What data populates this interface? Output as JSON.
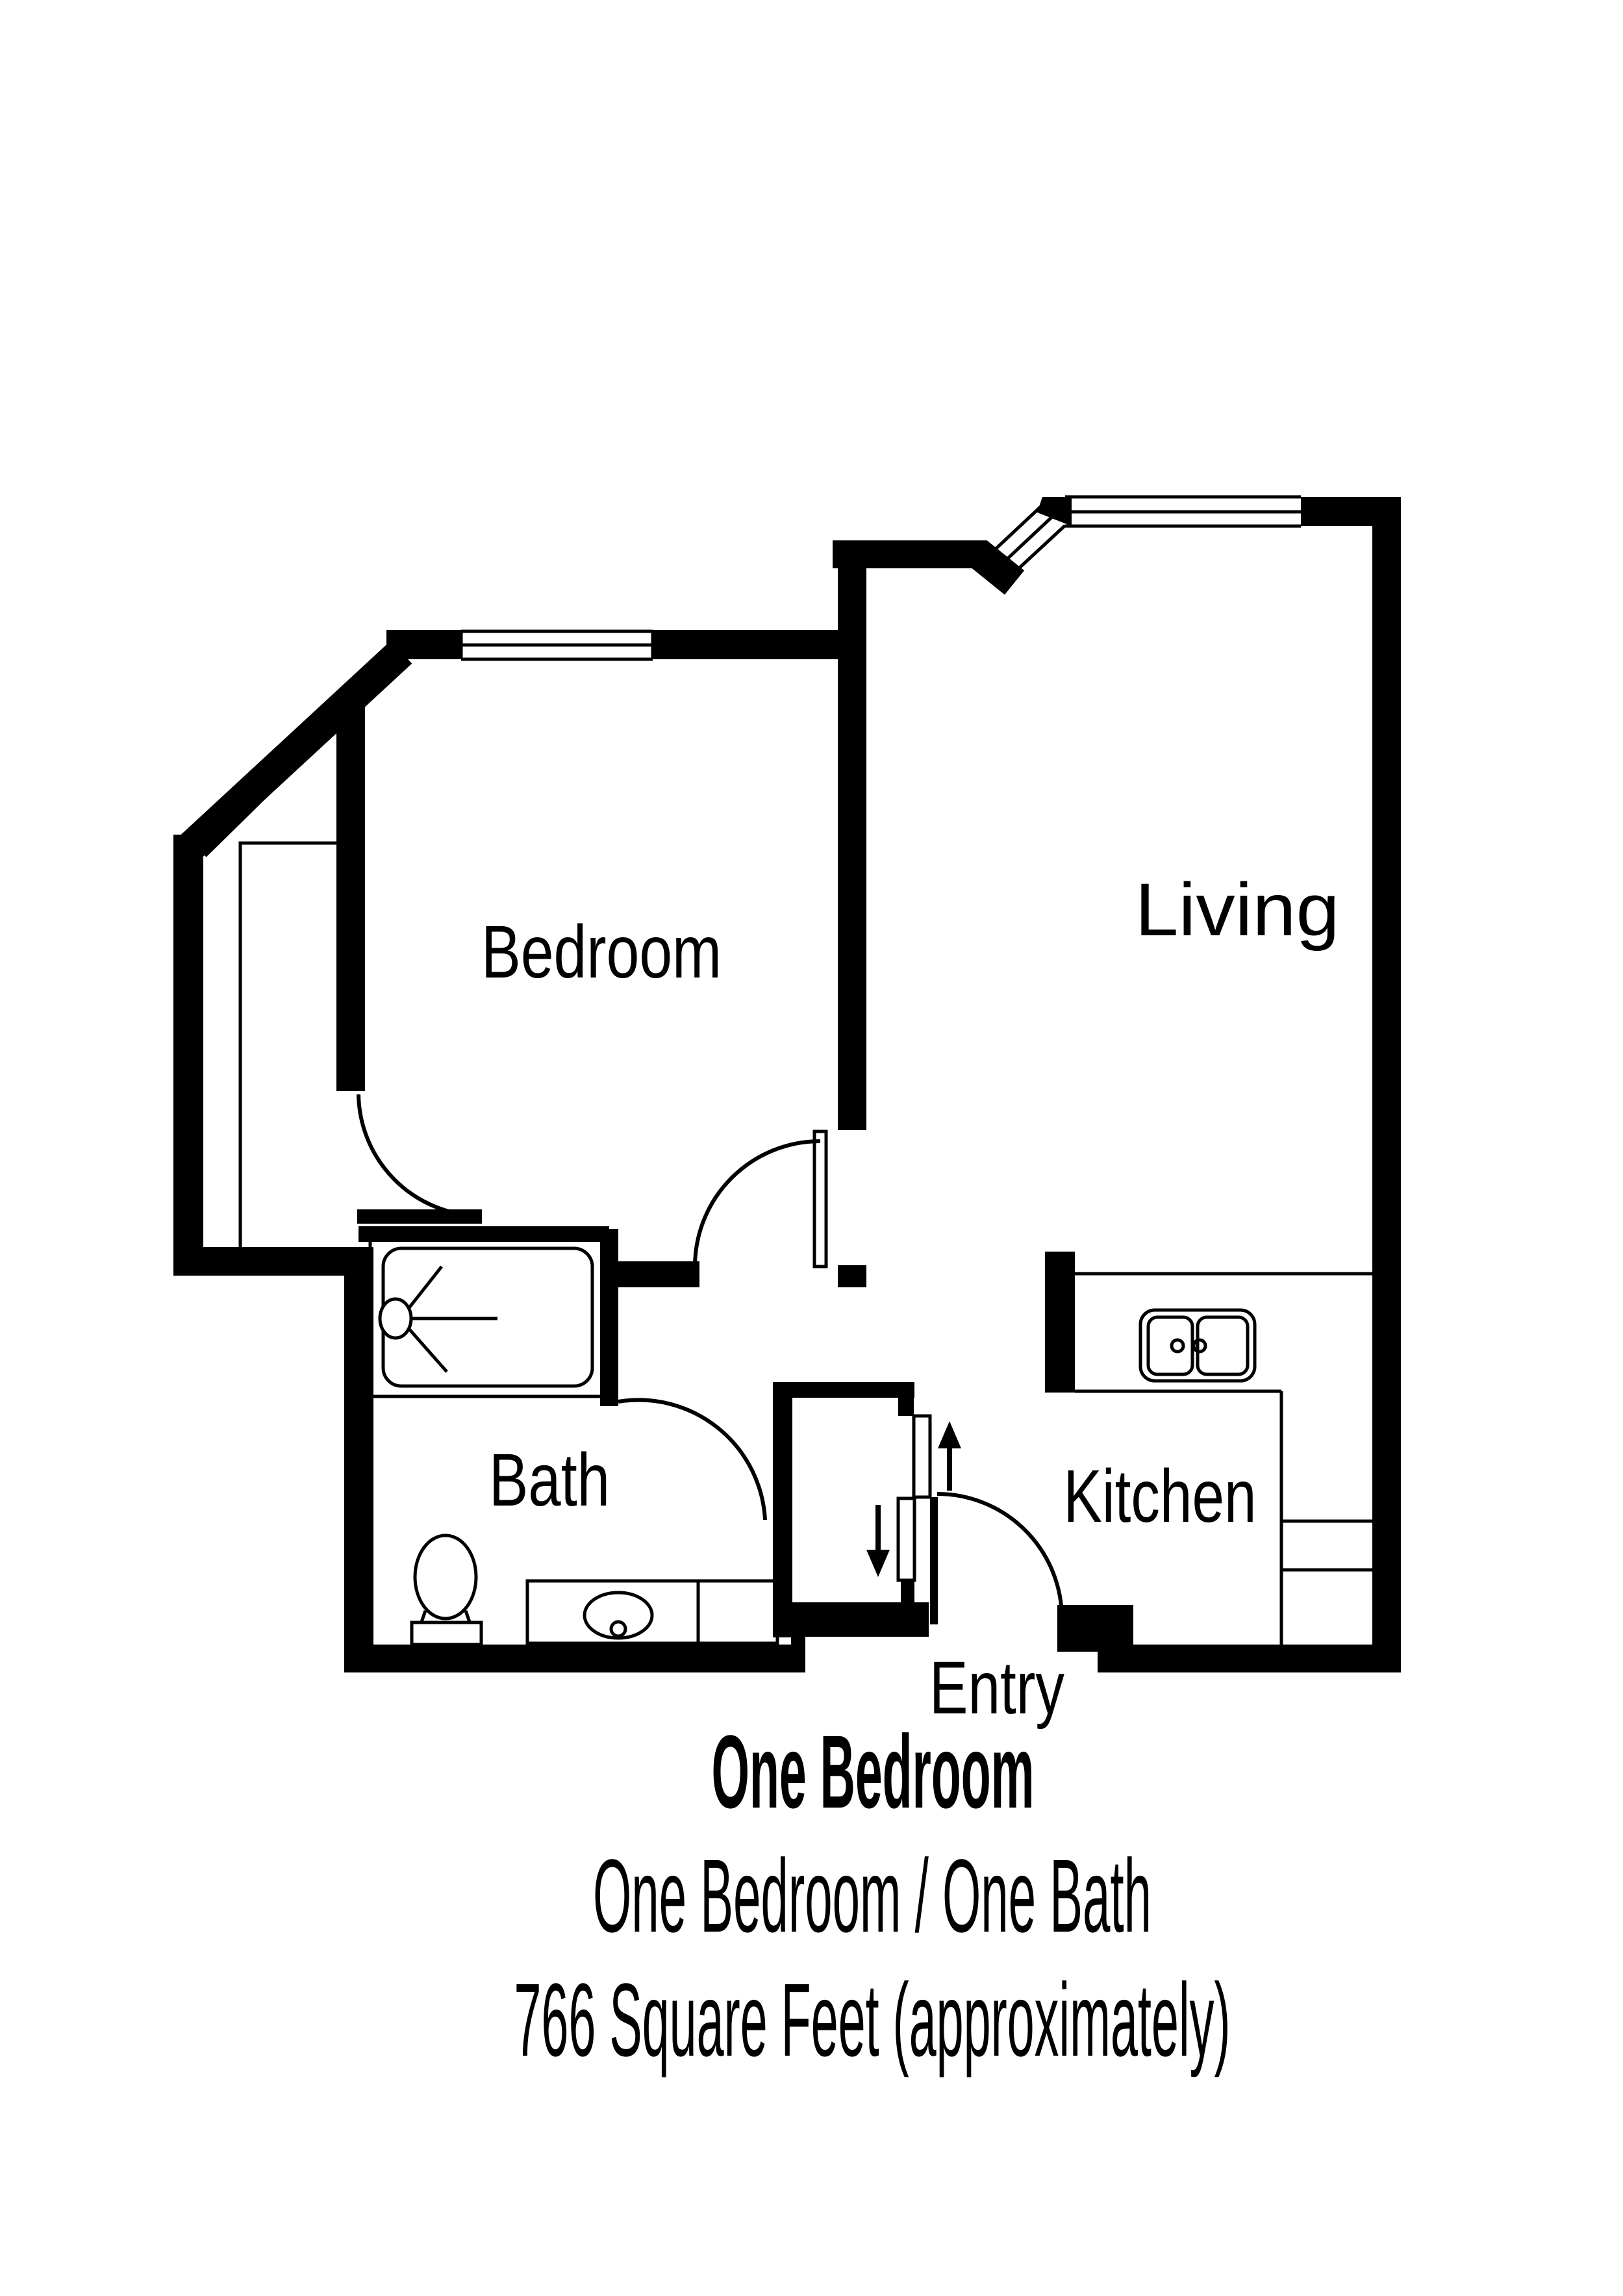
{
  "plan": {
    "colors": {
      "wall": "#000000",
      "background": "#ffffff",
      "text": "#000000"
    },
    "rooms": [
      {
        "id": "bedroom",
        "label": "Bedroom"
      },
      {
        "id": "living",
        "label": "Living"
      },
      {
        "id": "bath",
        "label": "Bath"
      },
      {
        "id": "kitchen",
        "label": "Kitchen"
      },
      {
        "id": "entry",
        "label": "Entry"
      }
    ],
    "fixtures": [
      "shower-icon",
      "shower-head-icon",
      "toilet-icon",
      "vanity-sink-icon",
      "kitchen-double-sink-icon",
      "closet-icon",
      "sliding-door-panels-icon",
      "door-swing-arc-icon",
      "entry-in-arrow-icon",
      "entry-out-arrow-icon",
      "window-icon",
      "bay-window-icon"
    ]
  },
  "caption": {
    "title": "One Bedroom",
    "subtitle": "One Bedroom / One Bath",
    "area": "766 Square Feet (approximately)"
  }
}
